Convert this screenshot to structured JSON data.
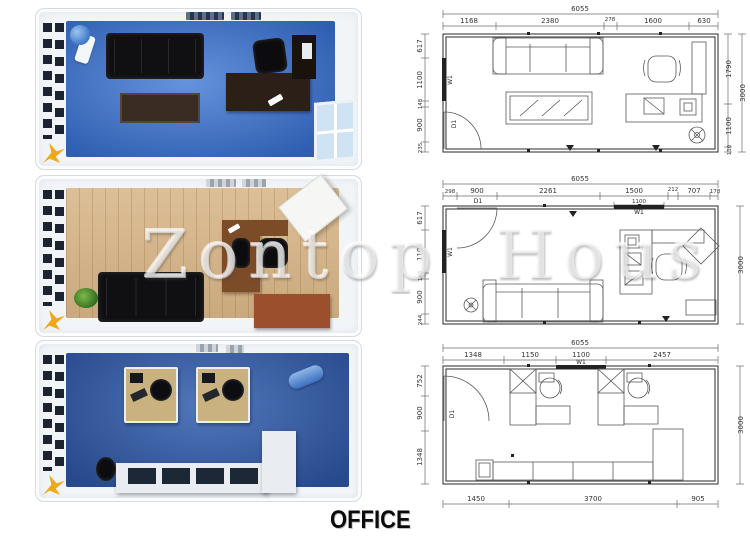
{
  "caption": "OFFICE",
  "watermark": "Zontop Hous",
  "colors": {
    "floor_blue": "#3a74d2",
    "floor_wood": "#d9b88c",
    "floor_blue_dark": "#335fae",
    "sofa_black": "#101012",
    "table_brown": "#3b2c23",
    "desk_dark": "#2b1f17",
    "desk_brown": "#7c4b28",
    "desk_tan": "#c9b180",
    "cabinet_dark": "#19120d",
    "cabinet_red": "#9c4f2c",
    "counter_white": "#e9edf1",
    "logo_yellow": "#f0a818"
  },
  "renders": [
    {
      "label": "blue lounge office render"
    },
    {
      "label": "wood floor office render"
    },
    {
      "label": "blue workstation office render"
    }
  ],
  "plans": [
    {
      "overall_width": "6055",
      "overall_height": "3000",
      "top_dims": [
        "1168",
        "2380",
        "278",
        "1600",
        "630"
      ],
      "left_dims": [
        "617",
        "1100",
        "148",
        "900",
        "235"
      ],
      "right_dims": [
        "1790",
        "1100",
        "110"
      ],
      "window_label": "W1",
      "door_label": "D1"
    },
    {
      "overall_width": "6055",
      "overall_height": "3000",
      "top_dims": [
        "298",
        "900",
        "2261",
        "1500",
        "212",
        "707",
        "178"
      ],
      "window_width": "1100",
      "left_dims": [
        "617",
        "1100",
        "148",
        "900",
        "244"
      ],
      "window_label": "W1",
      "door_label": "D1"
    },
    {
      "overall_width": "6055",
      "overall_height": "3000",
      "top_dims": [
        "1348",
        "1150",
        "1100",
        "2457"
      ],
      "left_dims": [
        "752",
        "900",
        "1348"
      ],
      "bottom_dims": [
        "1450",
        "3700",
        "905"
      ],
      "window_label": "W1",
      "door_label": "D1"
    }
  ]
}
